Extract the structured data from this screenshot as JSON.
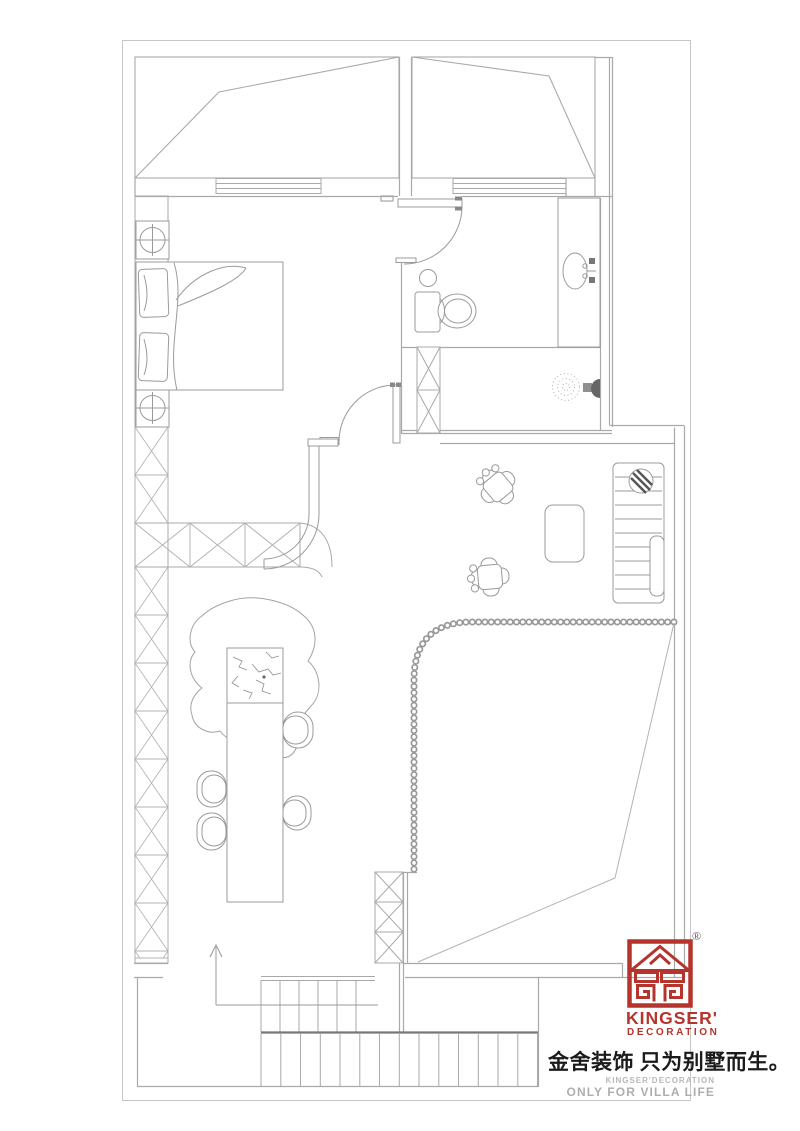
{
  "branding": {
    "logo_text": "KINGSER'",
    "logo_subtext": "DECORATION",
    "registered_mark": "®",
    "slogan_cn": "金舍装饰 只为别墅而生。",
    "footer_line1": "KINGSER'DECORATION",
    "footer_line2": "ONLY FOR VILLA LIFE",
    "logo_color": "#b5342c"
  },
  "drawing": {
    "type": "attic-floor-plan",
    "line_color": "#a9a9a9",
    "frame_color": "#c6c6c6",
    "features": [
      "attic-roof-slope-left",
      "attic-roof-slope-right",
      "window-band",
      "double-bed",
      "pillow",
      "nightstand-column-symbol",
      "hatched-storage-wall",
      "curved-partition-wall",
      "bedroom-door",
      "bathroom-door",
      "toilet",
      "toilet-paper-holder",
      "vanity-sink",
      "shower-spray",
      "shower-head",
      "structural-column",
      "rock-feature",
      "long-bar-table",
      "dining-chair",
      "armchair",
      "ottoman",
      "shelf-unit",
      "potted-plant",
      "bead-curtain-edge",
      "sloped-ceiling-fold-line",
      "staircase",
      "stair-direction-arrow"
    ]
  }
}
